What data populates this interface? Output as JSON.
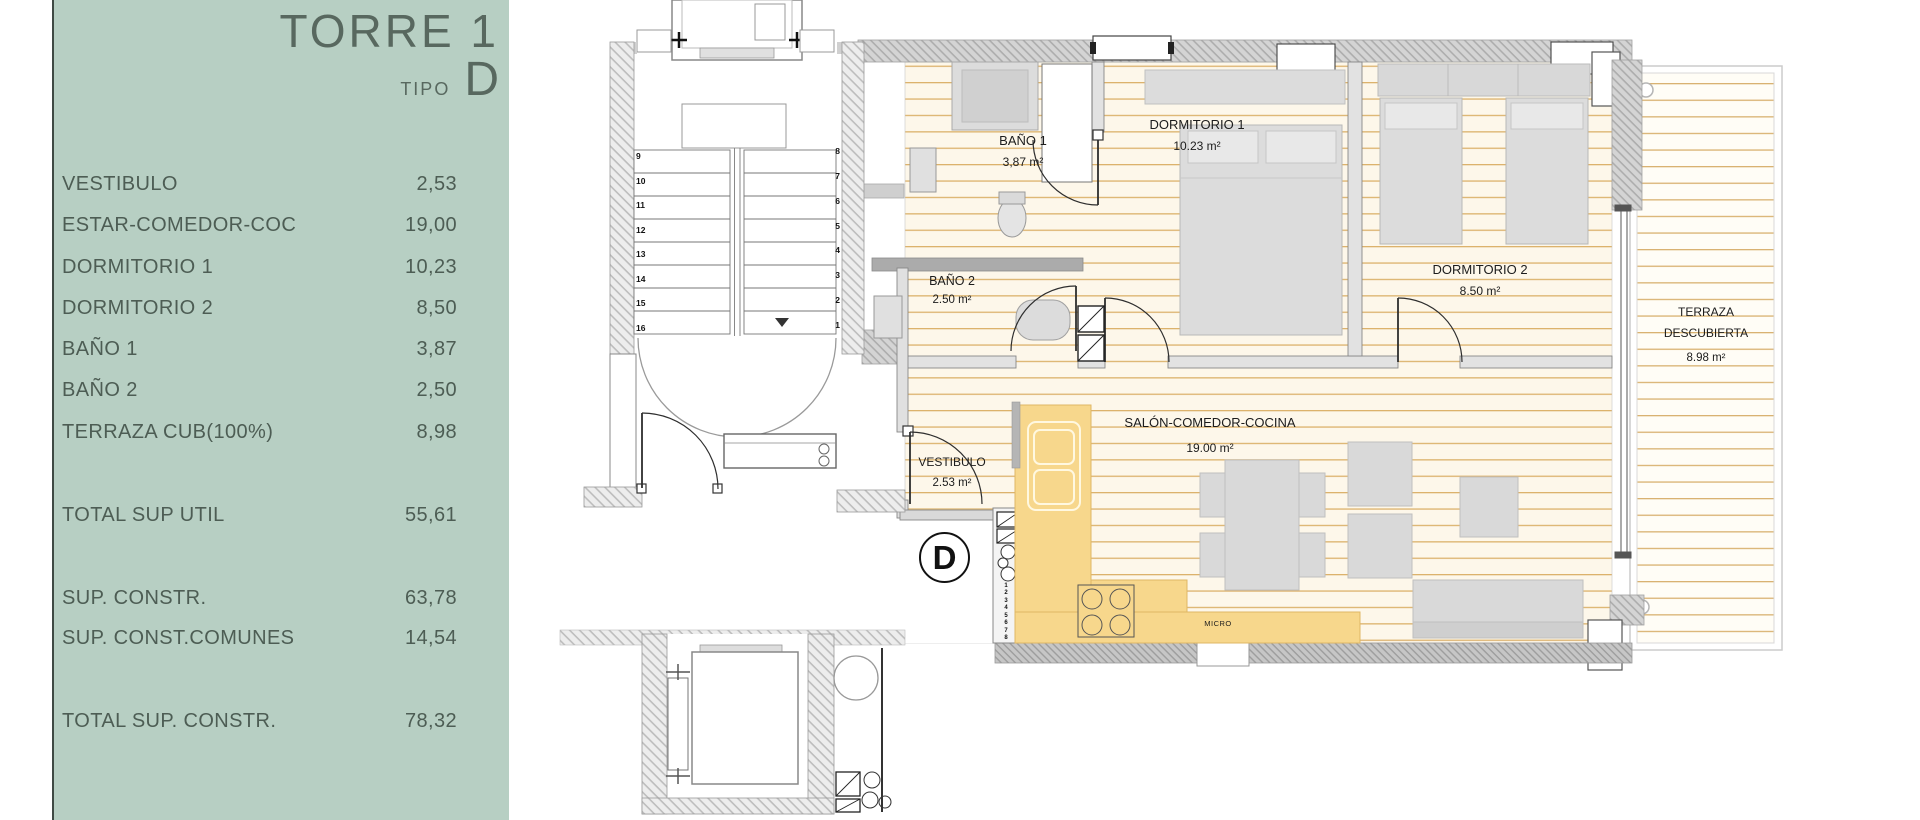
{
  "sidebar": {
    "title": "TORRE 1",
    "subtitle_label": "TIPO",
    "subtitle_value": "D",
    "rooms": [
      {
        "label": "VESTIBULO",
        "value": "2,53"
      },
      {
        "label": "ESTAR-COMEDOR-COC",
        "value": "19,00"
      },
      {
        "label": "DORMITORIO 1",
        "value": "10,23"
      },
      {
        "label": "DORMITORIO 2",
        "value": "8,50"
      },
      {
        "label": "BAÑO 1",
        "value": "3,87"
      },
      {
        "label": "BAÑO 2",
        "value": "2,50"
      },
      {
        "label": "TERRAZA CUB(100%)",
        "value": "8,98"
      }
    ],
    "summary": {
      "total_util": {
        "label": "TOTAL SUP UTIL",
        "value": "55,61"
      },
      "sup_constr": {
        "label": "SUP. CONSTR.",
        "value": "63,78"
      },
      "comunes": {
        "label": "SUP. CONST.COMUNES",
        "value": "14,54"
      },
      "total_constr": {
        "label": "TOTAL SUP. CONSTR.",
        "value": "78,32"
      }
    },
    "colors": {
      "background": "#b7cfc3",
      "text": "#4d5d54"
    }
  },
  "plan": {
    "badge": "D",
    "labels": {
      "bano1": {
        "name": "BAÑO 1",
        "area": "3,87 m²"
      },
      "dorm1": {
        "name": "DORMITORIO 1",
        "area": "10.23 m²"
      },
      "dorm2": {
        "name": "DORMITORIO 2",
        "area": "8.50 m²"
      },
      "bano2": {
        "name": "BAÑO 2",
        "area": "2.50 m²"
      },
      "salon": {
        "name": "SALÓN-COMEDOR-COCINA",
        "area": "19.00 m²"
      },
      "vestibulo": {
        "name": "VESTIBULO",
        "area": "2.53 m²"
      },
      "terraza": {
        "name_line1": "TERRAZA",
        "name_line2": "DESCUBIERTA",
        "area": "8.98 m²"
      },
      "micro": "MICRO"
    },
    "stair_numbers_left": [
      "9",
      "10",
      "11",
      "12",
      "13",
      "14",
      "15",
      "16"
    ],
    "stair_numbers_right": [
      "8",
      "7",
      "6",
      "5",
      "4",
      "3",
      "2",
      "1"
    ],
    "duct_numbers": [
      "1",
      "2",
      "3",
      "4",
      "5",
      "6",
      "7",
      "8"
    ],
    "colors": {
      "kitchen": "#f7d78c",
      "floor_line": "#dcb26c",
      "wall": "#d4d4d4"
    }
  }
}
